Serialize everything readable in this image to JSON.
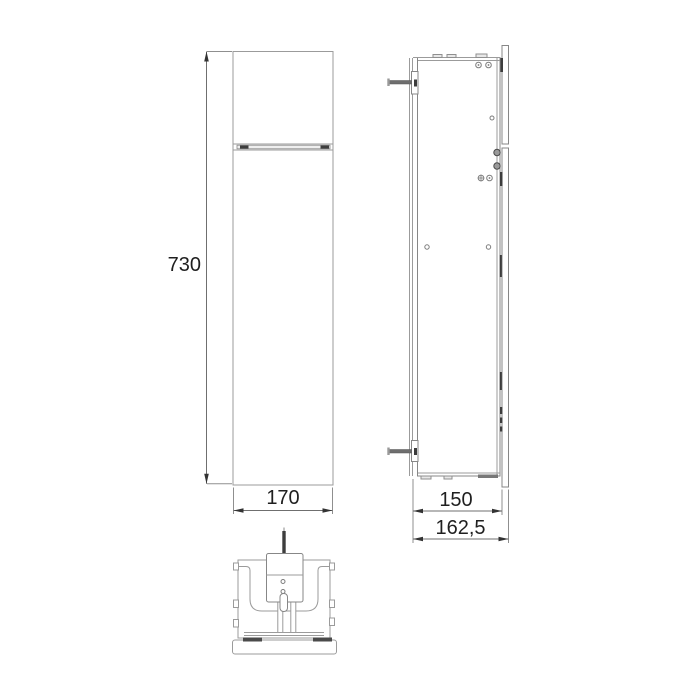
{
  "drawing": {
    "kind": "technical-three-view-drawing",
    "subject": "recessed wall cabinet module",
    "views": {
      "front": "front-elevation",
      "side": "side-section",
      "bottom": "bottom-view"
    },
    "dimensions": {
      "height": "730",
      "width": "170",
      "depth": "150",
      "total_depth": "162,5"
    },
    "colors": {
      "background": "#ffffff",
      "line": "#9b9b9b",
      "dark_detail": "#3d3d3d",
      "label_text": "#1f1f1f"
    }
  }
}
